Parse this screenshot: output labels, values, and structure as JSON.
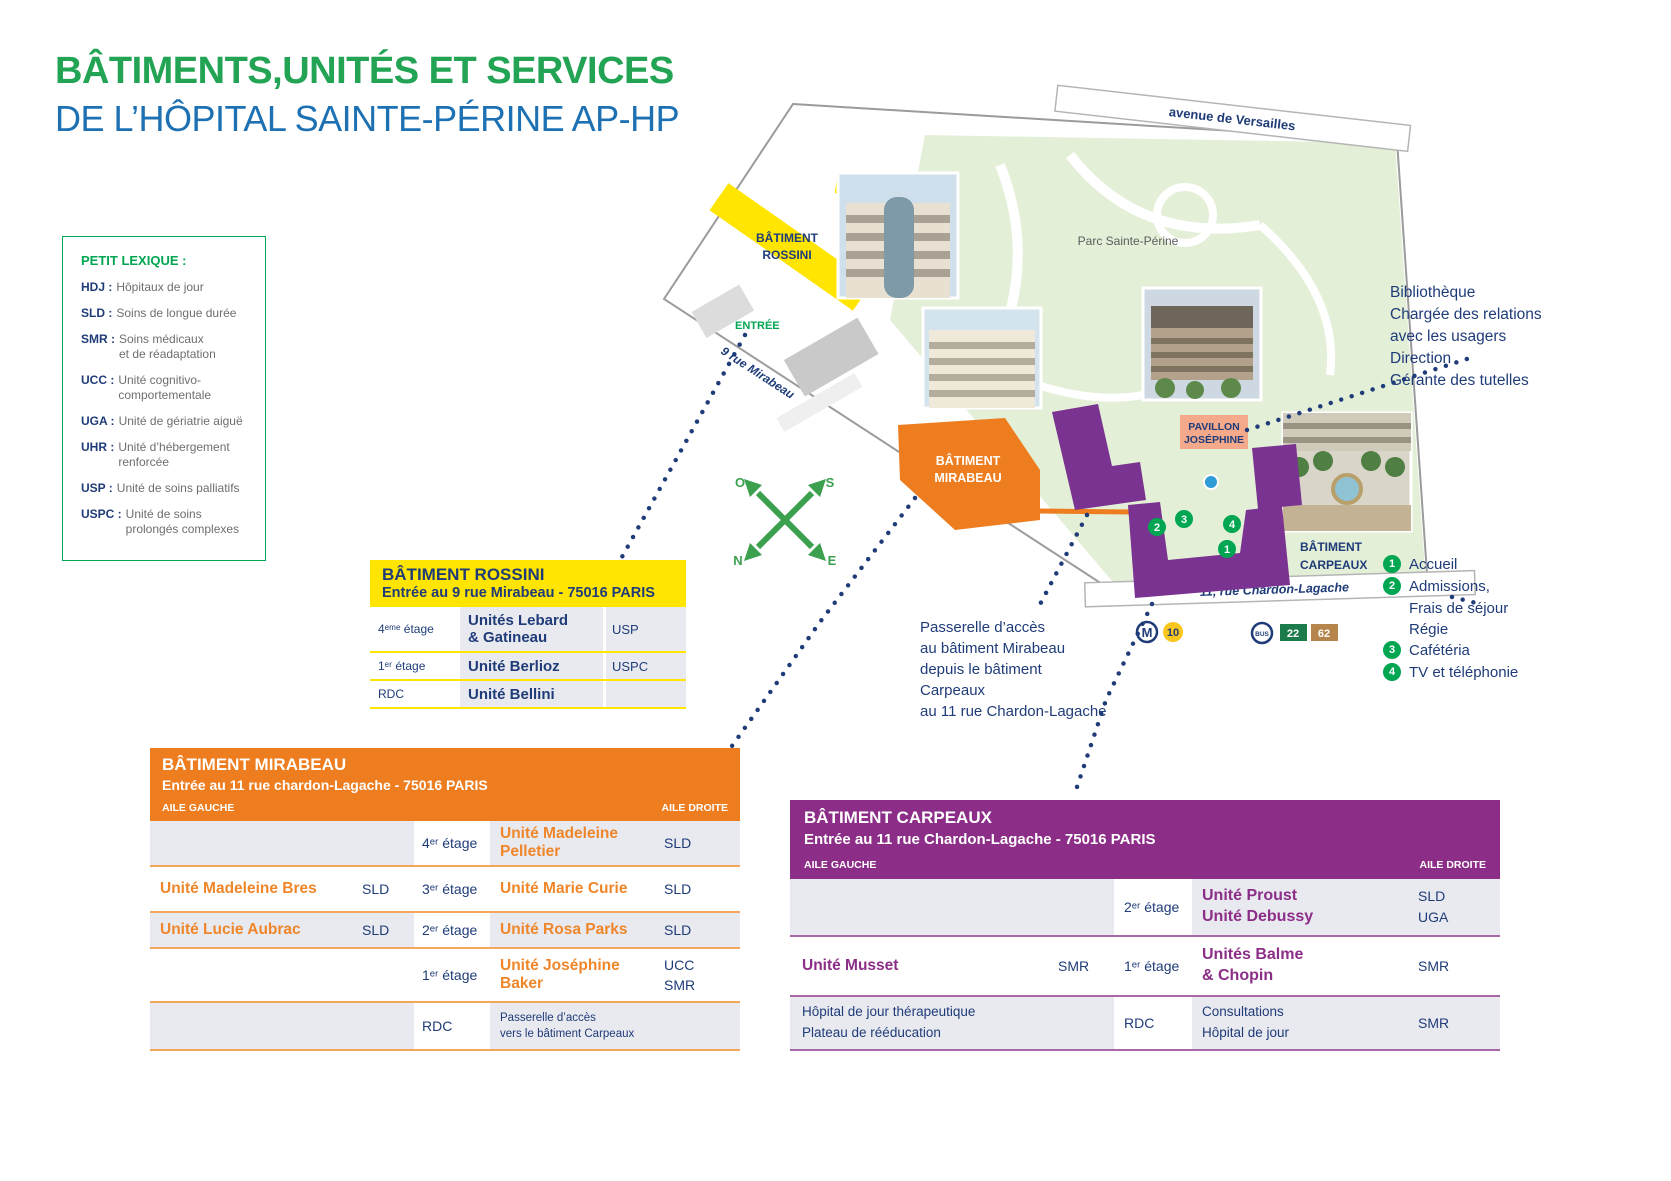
{
  "title": {
    "line1": "BÂTIMENTS,UNITÉS ET SERVICES",
    "line2": "DE L’HÔPITAL SAINTE-PÉRINE AP-HP"
  },
  "lexicon": {
    "title": "PETIT LEXIQUE :",
    "entries": [
      {
        "abbr": "HDJ :",
        "def": "Hôpitaux de jour"
      },
      {
        "abbr": "SLD :",
        "def": "Soins de longue durée"
      },
      {
        "abbr": "SMR :",
        "def": "Soins médicaux\net de réadaptation"
      },
      {
        "abbr": "UCC :",
        "def": "Unité cognitivo-\ncomportementale"
      },
      {
        "abbr": "UGA :",
        "def": "Unité de gériatrie aiguë"
      },
      {
        "abbr": "UHR :",
        "def": "Unité d’hébergement\nrenforcée"
      },
      {
        "abbr": "USP :",
        "def": "Unité de soins palliatifs"
      },
      {
        "abbr": "USPC :",
        "def": "Unité de soins\nprolongés complexes"
      }
    ]
  },
  "map": {
    "avenue": "avenue de Versailles",
    "park": "Parc Sainte-Périne",
    "rue_mirabeau": "9 rue Mirabeau",
    "rue_chardon": "11, rue Chardon-Lagache",
    "entree": "ENTRÉE",
    "rossini": [
      "BÂTIMENT",
      "ROSSINI"
    ],
    "mirabeau": [
      "BÂTIMENT",
      "MIRABEAU"
    ],
    "carpeaux": [
      "BÂTIMENT",
      "CARPEAUX"
    ],
    "josephine": [
      "PAVILLON",
      "JOSÉPHINE"
    ],
    "compass": {
      "o": "O",
      "s": "S",
      "n": "N",
      "e": "E"
    },
    "markers": [
      "1",
      "2",
      "3",
      "4"
    ],
    "metro": {
      "m": "M",
      "line": "10"
    },
    "bus": {
      "label": "BUS",
      "lines": [
        "22",
        "62"
      ]
    }
  },
  "notes": {
    "services": [
      "Bibliothèque",
      "Chargée des relations",
      "avec les usagers",
      "Direction",
      "Gérante des tutelles"
    ],
    "passerelle": [
      "Passerelle d’accès",
      "au bâtiment Mirabeau",
      "depuis le bâtiment",
      "Carpeaux",
      "au 11 rue Chardon-Lagache"
    ]
  },
  "legend": [
    {
      "num": "1",
      "lines": [
        "Accueil"
      ]
    },
    {
      "num": "2",
      "lines": [
        "Admissions,",
        "Frais de séjour",
        "Régie"
      ]
    },
    {
      "num": "3",
      "lines": [
        "Cafétéria"
      ]
    },
    {
      "num": "4",
      "lines": [
        "TV et téléphonie"
      ]
    }
  ],
  "tables": {
    "rossini": {
      "name": "BÂTIMENT ROSSINI",
      "address": "Entrée au 9 rue Mirabeau - 75016 PARIS",
      "rows": [
        {
          "floor": "4ᵉᵐᵉ étage",
          "unit": "Unités Lebard\n& Gatineau",
          "code": "USP"
        },
        {
          "floor": "1ᵉʳ étage",
          "unit": "Unité Berlioz",
          "code": "USPC"
        },
        {
          "floor": "RDC",
          "unit": "Unité Bellini",
          "code": ""
        }
      ]
    },
    "mirabeau": {
      "name": "BÂTIMENT MIRABEAU",
      "address": "Entrée au 11 rue chardon-Lagache - 75016 PARIS",
      "aile_gauche": "AILE GAUCHE",
      "aile_droite": "AILE DROITE",
      "rows": [
        {
          "left_unit": "",
          "left_code": "",
          "floor": "4ᵉʳ étage",
          "right_unit": "Unité Madeleine Pelletier",
          "right_code": "SLD"
        },
        {
          "left_unit": "Unité Madeleine Bres",
          "left_code": "SLD",
          "floor": "3ᵉʳ étage",
          "right_unit": "Unité Marie Curie",
          "right_code": "SLD"
        },
        {
          "left_unit": "Unité Lucie Aubrac",
          "left_code": "SLD",
          "floor": "2ᵉʳ étage",
          "right_unit": "Unité Rosa Parks",
          "right_code": "SLD"
        },
        {
          "left_unit": "",
          "left_code": "",
          "floor": "1ᵉʳ étage",
          "right_unit": "Unité Joséphine Baker",
          "right_code": "UCC\nSMR"
        },
        {
          "left_unit": "",
          "left_code": "",
          "floor": "RDC",
          "right_unit": "Passerelle d’accès\nvers le bâtiment Carpeaux",
          "right_code": ""
        }
      ]
    },
    "carpeaux": {
      "name": "BÂTIMENT CARPEAUX",
      "address": "Entrée au 11 rue Chardon-Lagache - 75016 PARIS",
      "aile_gauche": "AILE GAUCHE",
      "aile_droite": "AILE DROITE",
      "rows": [
        {
          "left_unit": "",
          "left_code": "",
          "floor": "2ᵉʳ étage",
          "right_unit": "Unité Proust\nUnité Debussy",
          "right_code": "SLD\nUGA"
        },
        {
          "left_unit": "Unité Musset",
          "left_code": "SMR",
          "floor": "1ᵉʳ étage",
          "right_unit": "Unités Balme\n& Chopin",
          "right_code": "SMR"
        },
        {
          "left_unit": "Hôpital de jour thérapeutique\nPlateau de rééducation",
          "left_code": "",
          "floor": "RDC",
          "right_unit": "Consultations\nHôpital de jour",
          "right_code": "SMR"
        }
      ]
    }
  },
  "colors": {
    "green": "#00A651",
    "title_green": "#23A455",
    "title_blue": "#1D71B3",
    "navy": "#1F3C78",
    "yellow": "#FFE500",
    "orange": "#EE7D1F",
    "purple": "#8C2E87",
    "map_purple": "#7A3390",
    "salmon": "#F4A98B",
    "row_gray": "#E9E9F0",
    "park_green": "#E4EFD8",
    "bus_22": "#1B7B4A",
    "bus_62": "#B5854B",
    "metro_10": "#F9C51F"
  }
}
